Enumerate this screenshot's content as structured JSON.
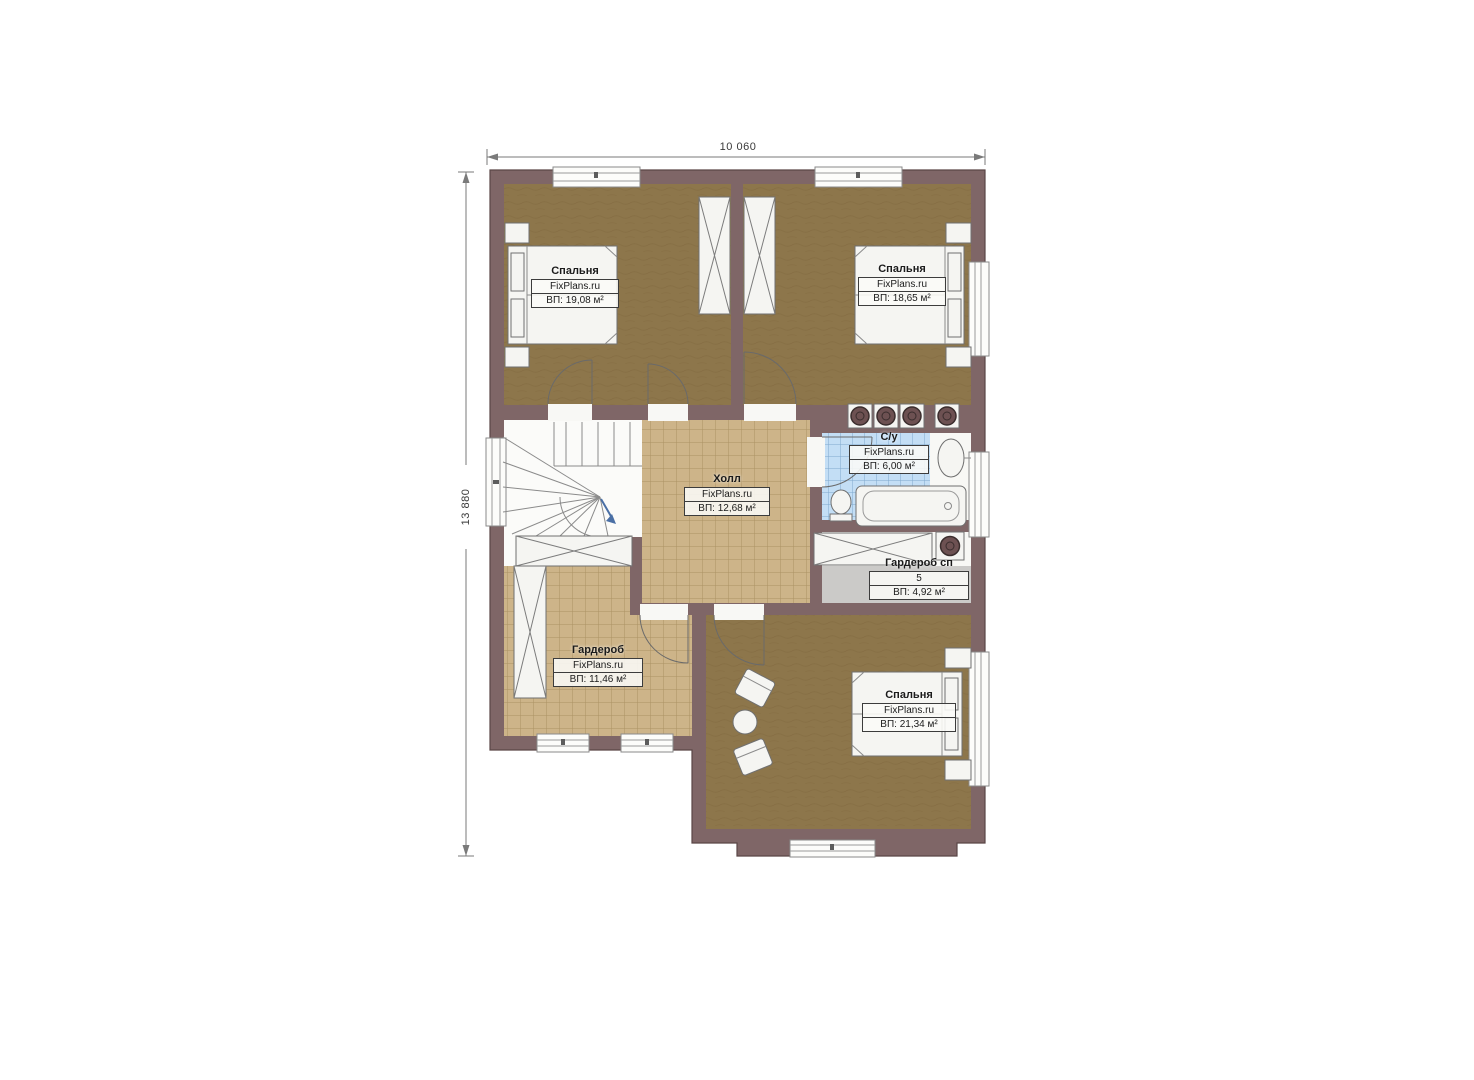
{
  "plan": {
    "dimensions": {
      "width_label": "10 060",
      "height_label": "13 880"
    },
    "rooms": {
      "bedroom_tl": {
        "name": "Спальня",
        "watermark": "FixPlans.ru",
        "area": "ВП: 19,08 м²"
      },
      "bedroom_tr": {
        "name": "Спальня",
        "watermark": "FixPlans.ru",
        "area": "ВП: 18,65 м²"
      },
      "hall": {
        "name": "Холл",
        "watermark": "FixPlans.ru",
        "area": "ВП: 12,68 м²"
      },
      "bathroom": {
        "name": "С/у",
        "watermark": "FixPlans.ru",
        "area": "ВП: 6,00 м²"
      },
      "wardrobe_sp": {
        "name": "Гардероб сп",
        "number": "5",
        "area": "ВП: 4,92 м²"
      },
      "wardrobe": {
        "name": "Гардероб",
        "watermark": "FixPlans.ru",
        "area": "ВП: 11,46 м²"
      },
      "bedroom_bottom": {
        "name": "Спальня",
        "watermark": "FixPlans.ru",
        "area": "ВП: 21,34 м²"
      }
    },
    "colors": {
      "wall": "#7f6667",
      "carpet": "#8d764b",
      "tile": "#cdb489",
      "tile_grid": "#a68c5e",
      "bath_tile": "#c3def5",
      "bath_grid": "#7fa8cd",
      "gray_floor": "#cbcac8",
      "fixture": "#f5f5f2"
    }
  }
}
